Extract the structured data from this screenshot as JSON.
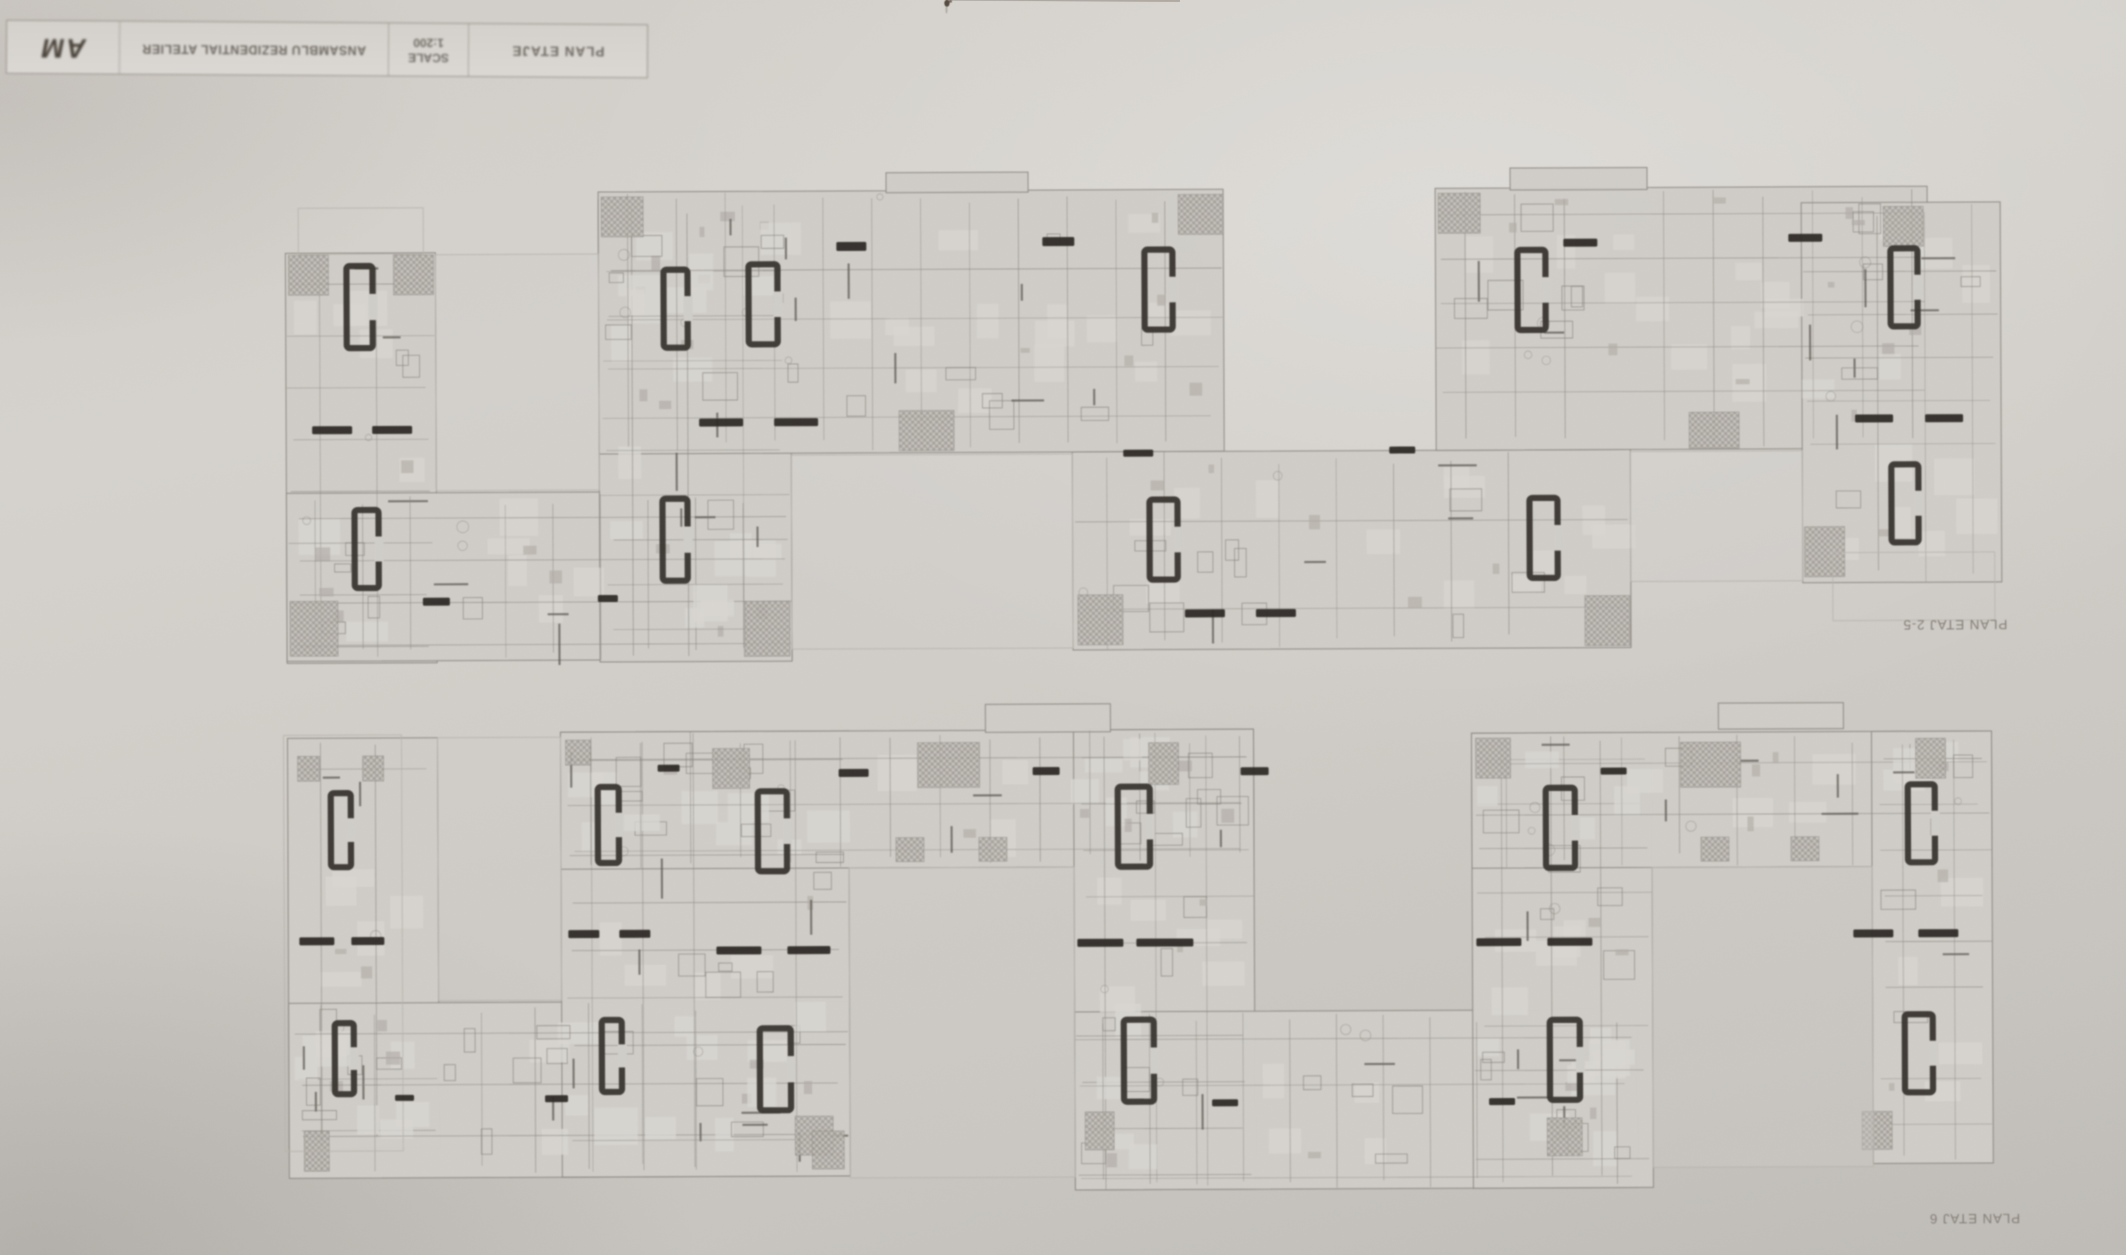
{
  "photo_label": "architectural floor plan sheet photographed upside down",
  "title_block": {
    "logo_text": "AM",
    "project_title": "ANSAMBLU REZIDENTIAL ATELIER",
    "scale_label": "SCALE",
    "scale_value": "1:200",
    "drawing_title": "PLAN ETAJE"
  },
  "colors": {
    "paper": "#d2cfca",
    "line": "#8d8882",
    "wall_dark": "#5a554f",
    "core": "#35302b",
    "bar": "#28241f",
    "hatch": "#9f9a94",
    "ghost": "#bab5af",
    "label_text": "#847d76",
    "wing_fill": "#d3d0cb"
  },
  "plans": [
    {
      "name": "upper-plan",
      "label": "PLAN ETAJ 2-5",
      "label_x": 1955,
      "label_y": 632,
      "wings": [
        [
          287,
          250,
          150,
          410
        ],
        [
          287,
          490,
          505,
          168
        ],
        [
          600,
          198,
          192,
          462
        ],
        [
          600,
          190,
          625,
          262
        ],
        [
          1073,
          452,
          558,
          198
        ],
        [
          1437,
          190,
          492,
          262
        ],
        [
          1803,
          206,
          199,
          380
        ],
        [
          888,
          172,
          142,
          20
        ],
        [
          1512,
          170,
          137,
          22
        ]
      ],
      "ghosts": [
        [
          300,
          205,
          125,
          46
        ],
        [
          1833,
          556,
          162,
          68
        ]
      ],
      "courtyards": [
        [
          437,
          252,
          163,
          236
        ],
        [
          792,
          454,
          281,
          194
        ],
        [
          1631,
          454,
          172,
          130
        ]
      ],
      "cores": [
        [
          348,
          263,
          26,
          82
        ],
        [
          355,
          507,
          24,
          78
        ],
        [
          665,
          268,
          24,
          78
        ],
        [
          663,
          497,
          25,
          82
        ],
        [
          750,
          263,
          29,
          80
        ],
        [
          1146,
          250,
          28,
          80
        ],
        [
          1150,
          500,
          28,
          80
        ],
        [
          1519,
          252,
          28,
          80
        ],
        [
          1530,
          500,
          28,
          80
        ],
        [
          1892,
          252,
          27,
          78
        ],
        [
          1892,
          468,
          27,
          78
        ]
      ],
      "bars": [
        [
          313,
          423,
          40,
          8
        ],
        [
          373,
          423,
          40,
          8
        ],
        [
          700,
          417,
          44,
          8
        ],
        [
          775,
          417,
          44,
          8
        ],
        [
          838,
          241,
          30,
          9
        ],
        [
          1044,
          237,
          32,
          9
        ],
        [
          1185,
          610,
          40,
          8
        ],
        [
          1256,
          610,
          40,
          8
        ],
        [
          1565,
          241,
          34,
          8
        ],
        [
          1790,
          237,
          34,
          8
        ],
        [
          1856,
          418,
          38,
          8
        ],
        [
          1926,
          418,
          38,
          8
        ],
        [
          423,
          595,
          27,
          8
        ],
        [
          598,
          593,
          20,
          7
        ],
        [
          1124,
          450,
          30,
          7
        ],
        [
          1390,
          448,
          26,
          7
        ]
      ],
      "hatches": [
        [
          603,
          195,
          42,
          40
        ],
        [
          1180,
          195,
          45,
          40
        ],
        [
          1440,
          195,
          42,
          40
        ],
        [
          1885,
          210,
          40,
          40
        ],
        [
          290,
          598,
          48,
          55
        ],
        [
          745,
          600,
          45,
          55
        ],
        [
          1078,
          595,
          45,
          50
        ],
        [
          1585,
          598,
          45,
          50
        ],
        [
          1805,
          530,
          40,
          50
        ],
        [
          900,
          410,
          55,
          40
        ],
        [
          1690,
          415,
          50,
          36
        ],
        [
          290,
          252,
          40,
          40
        ],
        [
          395,
          252,
          40,
          40
        ]
      ]
    },
    {
      "name": "lower-plan",
      "label": "PLAN ETAJ 6",
      "label_x": 1972,
      "label_y": 1226,
      "wings": [
        [
          287,
          735,
          150,
          410
        ],
        [
          287,
          1000,
          560,
          175
        ],
        [
          560,
          730,
          288,
          445
        ],
        [
          560,
          730,
          693,
          137
        ],
        [
          1073,
          730,
          180,
          460
        ],
        [
          1073,
          1012,
          562,
          178
        ],
        [
          1471,
          735,
          180,
          455
        ],
        [
          1471,
          735,
          520,
          135
        ],
        [
          1871,
          735,
          120,
          432
        ],
        [
          985,
          704,
          125,
          28
        ],
        [
          1718,
          706,
          125,
          26
        ]
      ],
      "ghosts": [
        [
          283,
          732,
          118,
          416
        ]
      ],
      "courtyards": [
        [
          437,
          735,
          123,
          263
        ],
        [
          848,
          867,
          225,
          310
        ],
        [
          1651,
          870,
          220,
          300
        ]
      ],
      "cores": [
        [
          330,
          790,
          20,
          74
        ],
        [
          333,
          1020,
          19,
          71
        ],
        [
          597,
          785,
          21,
          76
        ],
        [
          600,
          1018,
          20,
          72
        ],
        [
          757,
          790,
          29,
          80
        ],
        [
          1117,
          787,
          32,
          80
        ],
        [
          758,
          1027,
          31,
          82
        ],
        [
          1122,
          1020,
          30,
          82
        ],
        [
          1545,
          790,
          29,
          80
        ],
        [
          1907,
          788,
          27,
          78
        ],
        [
          1548,
          1022,
          30,
          80
        ],
        [
          1903,
          1018,
          28,
          78
        ]
      ],
      "bars": [
        [
          298,
          934,
          35,
          8
        ],
        [
          350,
          934,
          33,
          8
        ],
        [
          567,
          928,
          31,
          8
        ],
        [
          618,
          928,
          31,
          8
        ],
        [
          715,
          945,
          45,
          8
        ],
        [
          786,
          945,
          43,
          8
        ],
        [
          1076,
          939,
          46,
          8
        ],
        [
          1135,
          939,
          57,
          8
        ],
        [
          1475,
          940,
          45,
          8
        ],
        [
          1546,
          940,
          45,
          8
        ],
        [
          1852,
          933,
          40,
          8
        ],
        [
          1917,
          933,
          40,
          8
        ],
        [
          838,
          768,
          30,
          8
        ],
        [
          1032,
          767,
          27,
          8
        ],
        [
          657,
          763,
          22,
          7
        ],
        [
          393,
          1092,
          19,
          6
        ],
        [
          543,
          1093,
          23,
          7
        ],
        [
          1240,
          768,
          28,
          8
        ],
        [
          1600,
          770,
          26,
          7
        ],
        [
          1210,
          1100,
          26,
          7
        ],
        [
          1487,
          1100,
          26,
          7
        ]
      ],
      "hatches": [
        [
          297,
          753,
          22,
          25
        ],
        [
          362,
          753,
          21,
          25
        ],
        [
          712,
          747,
          37,
          40
        ],
        [
          917,
          742,
          62,
          45
        ],
        [
          1148,
          743,
          30,
          42
        ],
        [
          895,
          837,
          28,
          24
        ],
        [
          978,
          837,
          28,
          24
        ],
        [
          793,
          1115,
          38,
          39
        ],
        [
          1083,
          1112,
          29,
          38
        ],
        [
          302,
          1128,
          25,
          40
        ],
        [
          565,
          738,
          25,
          25
        ],
        [
          1475,
          740,
          35,
          40
        ],
        [
          1680,
          745,
          60,
          45
        ],
        [
          1915,
          742,
          30,
          40
        ],
        [
          1545,
          1120,
          35,
          38
        ],
        [
          1860,
          1115,
          30,
          38
        ],
        [
          1700,
          840,
          28,
          24
        ],
        [
          1790,
          840,
          28,
          24
        ],
        [
          810,
          1130,
          32,
          38
        ]
      ]
    }
  ]
}
